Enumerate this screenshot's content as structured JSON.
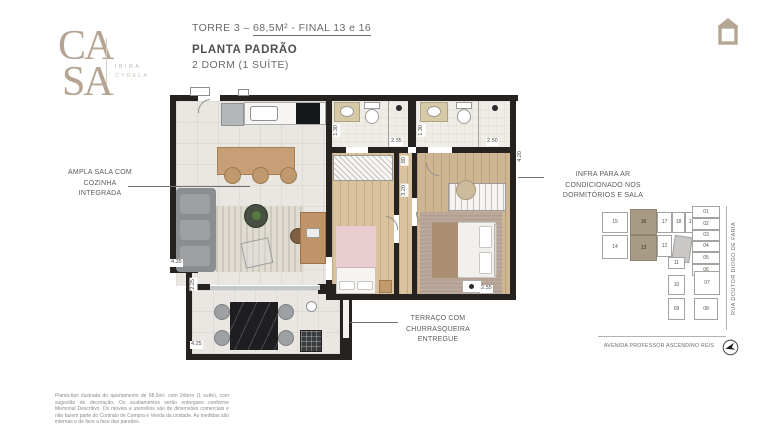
{
  "brand": {
    "logo_top": "CA",
    "logo_bottom": "SA",
    "tagline_line1": "IBIRA",
    "tagline_line2": "CYRELA"
  },
  "header": {
    "tower_prefix": "TORRE 3 – ",
    "tower_spec": "68,5M² - FINAL 13 e 16",
    "title": "PLANTA PADRÃO",
    "subtitle": "2 DORM (1 SUÍTE)"
  },
  "callouts": {
    "living": "AMPLA SALA COM\nCOZINHA\nINTEGRADA",
    "ac": "INFRA PARA AR\nCONDICIONADO NOS\nDORMITÓRIOS E SALA",
    "terrace": "TERRAÇO COM\nCHURRASQUEIRA\nENTREGUE"
  },
  "dimensions": {
    "terrace_width": "4.25",
    "terrace_depth": "2.25",
    "living_width": "4.35",
    "bath1_depth": "1.30",
    "bath1_width": "2.35",
    "bath2_depth": "1.30",
    "bath2_width": "2.50",
    "hall_width": ".80",
    "hall_depth": "3.20",
    "suite_depth": "4.20",
    "suite_width": "2.55"
  },
  "keyplan": {
    "units": [
      "15",
      "16",
      "17",
      "18",
      "19",
      "01",
      "02",
      "03",
      "04",
      "05",
      "06",
      "14",
      "13",
      "12",
      "11",
      "10",
      "07",
      "09",
      "08"
    ],
    "highlighted_units": [
      "16",
      "13"
    ],
    "highlight_color": "#a89b84"
  },
  "map": {
    "street_right": "RUA DOUTOR DIOGO DE FARIA",
    "street_bottom": "AVENIDA PROFESSOR ASCENDINO REIS"
  },
  "disclaimer": "Planta-tipo ilustrada do apartamento de 68,5m², com 2dorm (1 suíte), com sugestão de decoração. Os acabamentos serão entregues conforme Memorial Descritivo. Os móveis e utensílios são de dimensões comerciais e não fazem parte do Contrato de Compra e Venda da unidade. As medidas são internas e de face a face das paredes.",
  "colors": {
    "brand": "#b4a391",
    "wall": "#262220",
    "highlight": "#a89b84",
    "text_gray": "#6d6e71"
  }
}
